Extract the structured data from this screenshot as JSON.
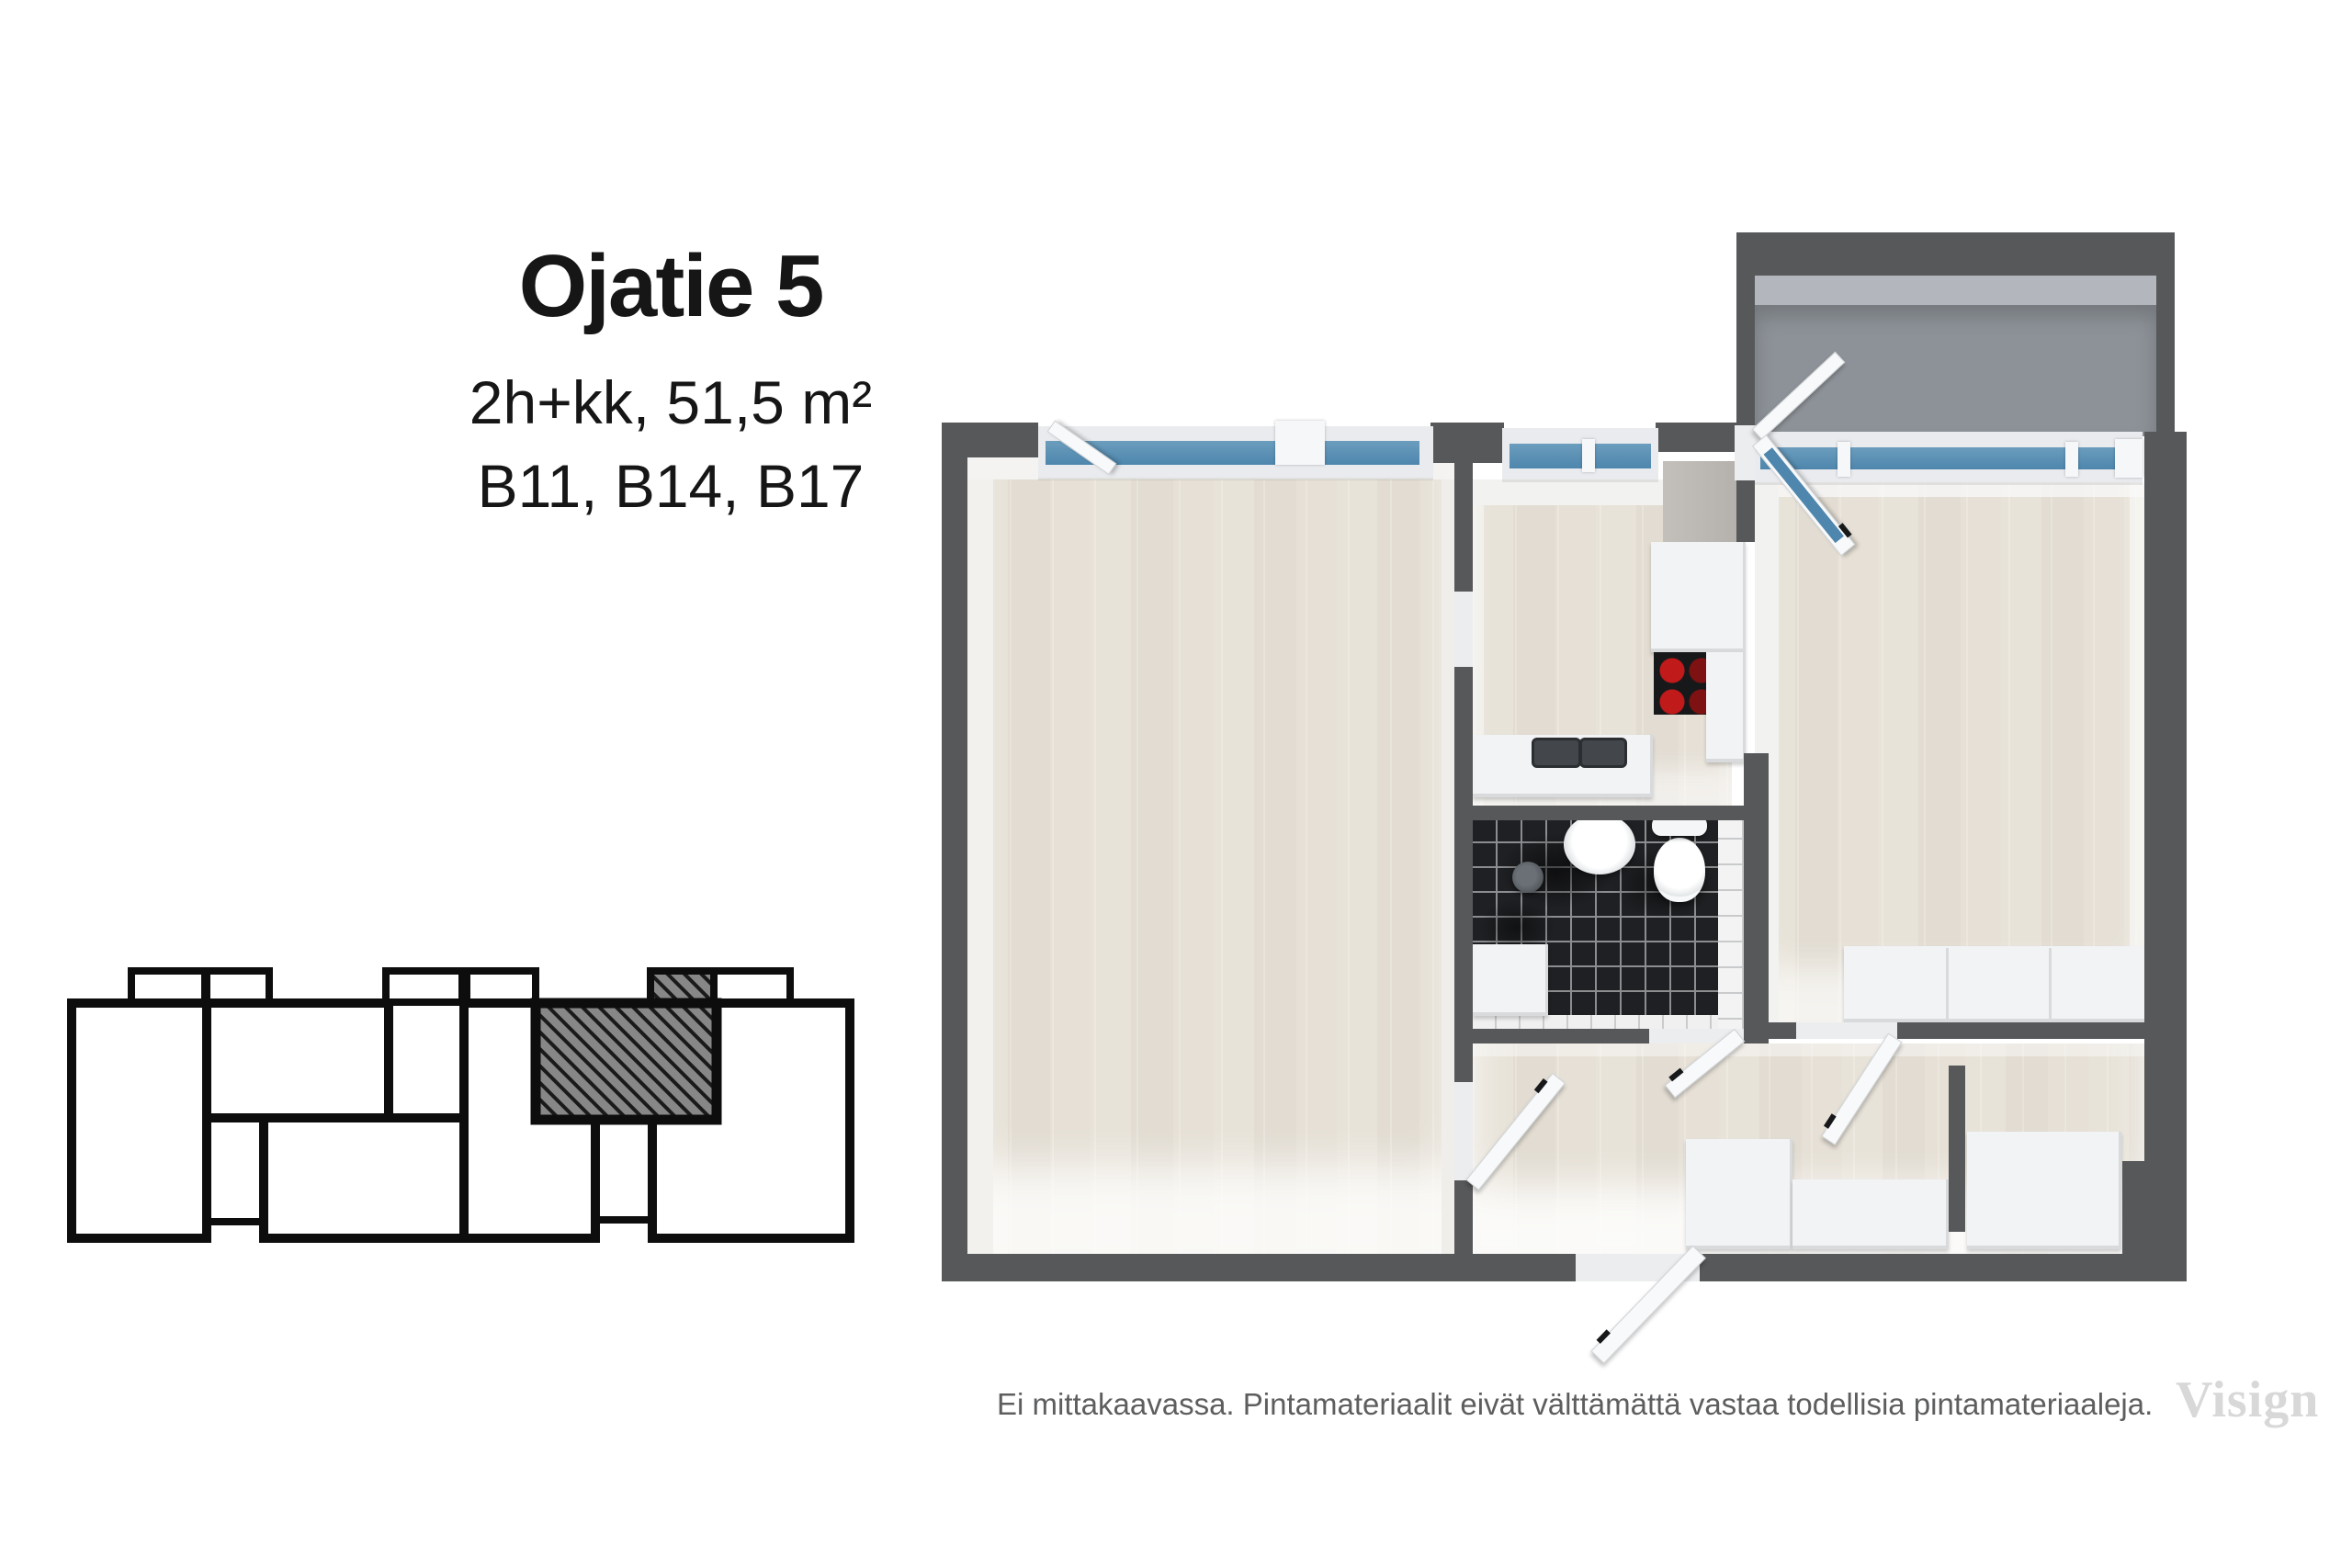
{
  "header": {
    "title": "Ojatie 5",
    "subtitle": "2h+kk, 51,5 m²",
    "units": "B11, B14, B17"
  },
  "footer": {
    "disclaimer": "Ei mittakaavassa. Pintamateriaalit eivät välttämättä vastaa todellisia pintamateriaaleja.",
    "watermark": "Visign"
  },
  "colors": {
    "text": "#161616",
    "muted": "#5d5e60",
    "watermark": "#d8d8d8",
    "wall": "#57585a",
    "window": "#4e86ad",
    "floor": "#e7e1d7",
    "balcony": "#8d9298",
    "balcony-face": "#b3b7bd",
    "tile-black": "#1f2023",
    "tile-grout": "#8b8d8f",
    "furniture": "#f2f3f5",
    "furniture-edge": "#d8dadc",
    "burner": "#c11a1a",
    "hatch-fill": "#878787",
    "hatch-line": "#1a1a1a",
    "outline": "#0d0d0d"
  }
}
